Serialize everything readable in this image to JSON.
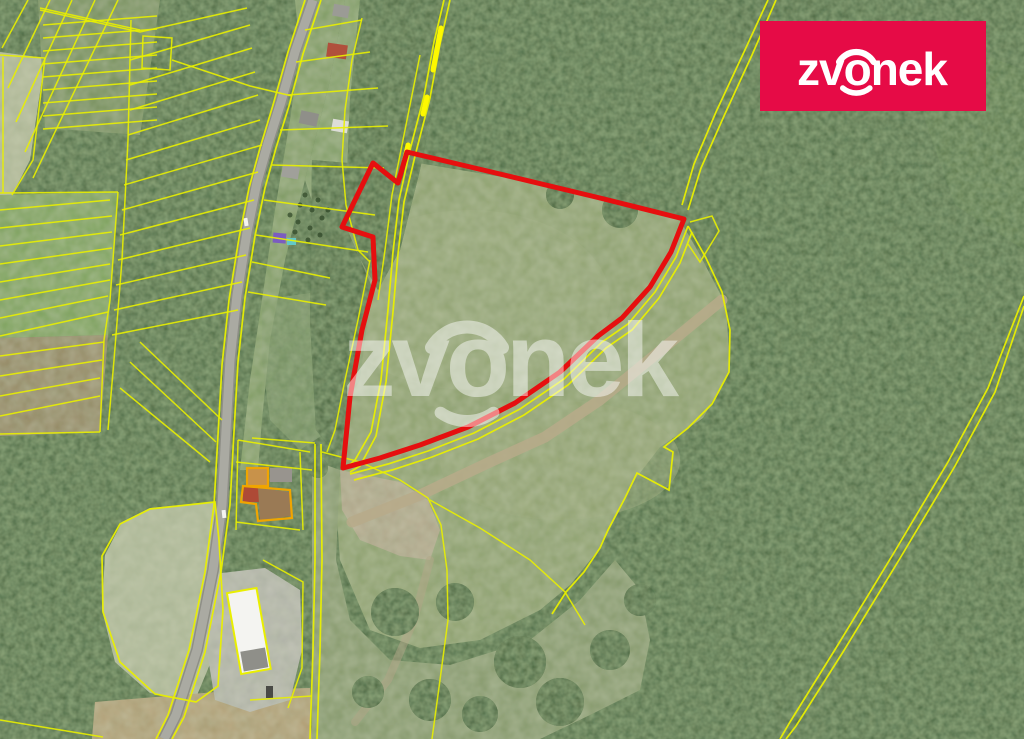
{
  "brand": {
    "logo_text": "zvonek",
    "watermark_text": "zvonek"
  },
  "map": {
    "overlay_legend": {
      "subject_parcel": "red outline polygon",
      "cadastral_parcels": "yellow outlines",
      "highlighted_access_segments": "bright yellow strokes"
    }
  },
  "colors": {
    "brand_red": "#e60b46",
    "subject_outline_red": "#e60f0f",
    "cadastral_yellow": "#e9ef00",
    "highlight_yellow": "#fef800",
    "farm_outline_orange": "#f0a500",
    "forest_green": "#415c35",
    "meadow_green": "#8da06c",
    "road_grey": "#a9a9a1"
  }
}
